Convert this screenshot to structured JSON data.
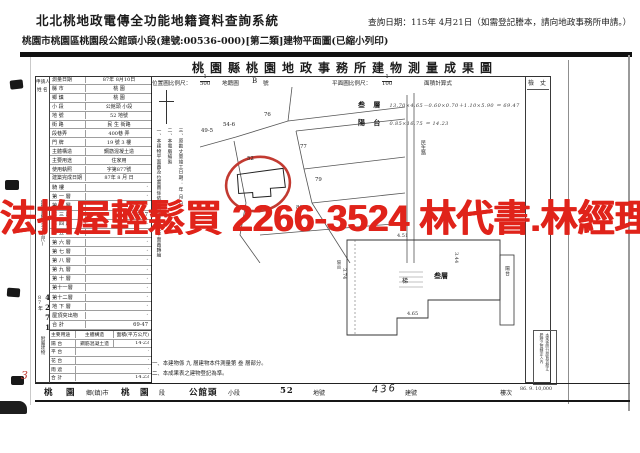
{
  "app": {
    "system_title": "北北桃地政電傳全功能地籍資料查詢系統",
    "query_date": "查詢日期：115年 4月21日（如需登記謄本，請向地政事務所申請。）",
    "subtitle": "桃園市桃園區桃園段公館頭小段(建號:00536-000)[第二類]建物平面圖(已縮小列印)"
  },
  "watermark": {
    "text": "法拍屋輕鬆買 2266-3524 林代書.林經理",
    "color": "#e0231a"
  },
  "doc": {
    "title": "桃園縣桃園地政事務所建物測量成果圖",
    "scale": {
      "loc_label": "位置圖比例尺：",
      "loc_num": "1",
      "loc_den": "500",
      "map_label": "地籍圖",
      "map_sheet": "B",
      "map_sheet_suffix": "號",
      "plan_label": "平面圖比例尺：",
      "plan_num": "1",
      "plan_den": "100",
      "calc_label": "面積計算式"
    },
    "applicant_label": "申請人",
    "applicant_name_label": "姓 名",
    "check_label": "檢 丈",
    "info_rows": [
      {
        "label": "測量日期",
        "value": "87年 8月10日"
      },
      {
        "label": "縣  市",
        "value": "桃  園"
      },
      {
        "label": "鄉  鎮",
        "value": "桃  園"
      },
      {
        "label": "小  段",
        "value": "公館頭 小段"
      },
      {
        "label": "地  號",
        "value": "52  地號"
      },
      {
        "label": "街  路",
        "value": "民 生  街路"
      },
      {
        "label": "段巷弄",
        "value": "400巷  弄"
      },
      {
        "label": "門  牌",
        "value": "19 號 3 樓"
      },
      {
        "label": "主體構造",
        "value": "鋼筋混凝土造"
      },
      {
        "label": "主要用途",
        "value": "住家用"
      },
      {
        "label": "使用執照",
        "value": "字第877號"
      },
      {
        "label": "建築完成日期",
        "value": "87年 8 月  日"
      }
    ],
    "floor_side_label": "建物面積(平方公尺)",
    "floor_rows": [
      {
        "label": "騎  樓",
        "value": "·"
      },
      {
        "label": "第 一 層",
        "value": "·"
      },
      {
        "label": "第 二 層",
        "value": "·"
      },
      {
        "label": "第 三 層",
        "value": "69·47"
      },
      {
        "label": "第 四 層",
        "value": "·"
      },
      {
        "label": "第 五 層",
        "value": "·"
      },
      {
        "label": "第 六 層",
        "value": "·"
      },
      {
        "label": "第 七 層",
        "value": "·"
      },
      {
        "label": "第 八 層",
        "value": "·"
      },
      {
        "label": "第 九 層",
        "value": "·"
      },
      {
        "label": "第 十 層",
        "value": "·"
      },
      {
        "label": "第十一層",
        "value": "·"
      },
      {
        "label": "第十二層",
        "value": "·"
      },
      {
        "label": "地 下 層",
        "value": "·"
      },
      {
        "label": "屋頂突出物",
        "value": "·"
      },
      {
        "label": "合  計",
        "value": "69·47"
      }
    ],
    "receipt": {
      "year": "87年",
      "number": "4271"
    },
    "attached": {
      "side_label": "附屬建物",
      "headers": [
        "主要用途",
        "主體構造",
        "面積(平方公尺)"
      ],
      "rows": [
        {
          "use": "陽 台",
          "structure": "鋼筋混凝土造",
          "area": "14·23"
        },
        {
          "use": "平 台",
          "structure": "",
          "area": "·"
        },
        {
          "use": "花 台",
          "structure": "",
          "area": "·"
        },
        {
          "use": "雨 遮",
          "structure": "",
          "area": "·"
        },
        {
          "use": "合 計",
          "structure": "",
          "area": "14.23"
        }
      ]
    },
    "notes_vertical": [
      "三、原勘丈量竣工日期： 年 月 日",
      "二、本電腦繪製",
      "一、本建物平面圖及位置圖係依使用執照竣工平面圖轉繪"
    ],
    "map": {
      "parcels": [
        {
          "t": "76",
          "x": 64,
          "y": 31
        },
        {
          "t": "77",
          "x": 100,
          "y": 63
        },
        {
          "t": "79",
          "x": 115,
          "y": 96
        },
        {
          "t": "81",
          "x": 96,
          "y": 124
        },
        {
          "t": "49-5",
          "x": 1,
          "y": 47
        },
        {
          "t": "54-6",
          "x": 23,
          "y": 41
        },
        {
          "t": "52",
          "x": 47,
          "y": 75
        }
      ],
      "road_label": "民生路"
    },
    "plan": {
      "room_label": "叁層",
      "stair_label": "梯",
      "balcony_label": "陽台",
      "left_label": "陽台",
      "dims": [
        {
          "t": "4.51",
          "x": 64,
          "y": 7,
          "v": false
        },
        {
          "t": "4.65",
          "x": 74,
          "y": 85,
          "v": false
        },
        {
          "t": "3.44",
          "x": 122,
          "y": 22,
          "v": true
        },
        {
          "t": "3.74",
          "x": 10,
          "y": 38,
          "v": true
        }
      ]
    },
    "formulas": [
      {
        "name": "叁 層",
        "expr": "13.70×4.65－0.60×0.70＋1.10×5.90 ＝ 69.47"
      },
      {
        "name": "陽 台",
        "expr": "0.85×16.75 ＝ 14.23"
      }
    ],
    "bottom_notes": [
      "一、本建物係 九 層建物本件測量第 叁 層部分。",
      "二、本成果表之建物登記為準。"
    ],
    "footer": [
      {
        "t": "桃",
        "x": 44,
        "big": true
      },
      {
        "t": "園",
        "x": 66,
        "big": true
      },
      {
        "t": "鄉(鎮)市",
        "x": 86,
        "big": false
      },
      {
        "t": "桃",
        "x": 121,
        "big": true
      },
      {
        "t": "園",
        "x": 140,
        "big": true
      },
      {
        "t": "段",
        "x": 159,
        "big": false
      },
      {
        "t": "公館頭",
        "x": 189,
        "big": true
      },
      {
        "t": "小段",
        "x": 228,
        "big": false
      },
      {
        "t": "52",
        "x": 280,
        "big": true
      },
      {
        "t": "地號",
        "x": 313,
        "big": false
      },
      {
        "t": "436",
        "x": 372,
        "big": true,
        "hand": true
      },
      {
        "t": "建號",
        "x": 405,
        "big": false
      },
      {
        "t": "樓次",
        "x": 500,
        "big": false
      }
    ],
    "stamp_lines": [
      "謄繪之管轄定入內",
      "本案係照分層負責勘丈"
    ],
    "print_code": "86. 9. 10,000",
    "pen_mark": "3"
  }
}
